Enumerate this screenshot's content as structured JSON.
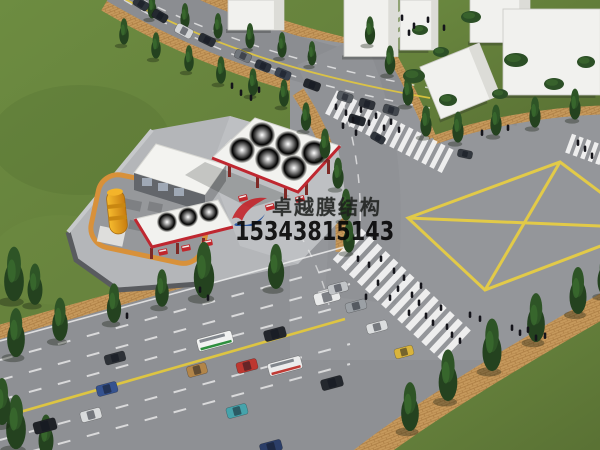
{
  "watermark": {
    "company": "卓越膜结构",
    "phone": "15343815143",
    "logo_colors": {
      "red": "#c42128",
      "blue": "#1f4e9c"
    }
  },
  "scene": {
    "description": "Aerial 3D rendering of a gas station with white tensile membrane canopies beside a multi-lane city road intersection with a yellow box-junction marking",
    "palette": {
      "grass": "#617f38",
      "road": "#909296",
      "sidewalk_brick": "#c6995c",
      "lane_yellow": "#e2c83e",
      "crosswalk_white": "#f7f7f7",
      "canopy_white": "#f2f2ef",
      "canopy_trim_red": "#bf2730",
      "tree_green": "#24421f",
      "building_white": "#f1f1ee",
      "fuel_tank_orange": "#e8a125",
      "tank_ring_orange": "#d8913a"
    },
    "buildings": [
      {
        "x": 419,
        "y": 25,
        "w": 38,
        "h": 50,
        "r": 0
      },
      {
        "x": 256,
        "y": 15,
        "w": 56,
        "h": 30,
        "r": 0
      },
      {
        "x": 371,
        "y": 28,
        "w": 54,
        "h": 57,
        "r": 0
      },
      {
        "x": 500,
        "y": 21,
        "w": 60,
        "h": 43,
        "r": 0
      },
      {
        "x": 562,
        "y": 52,
        "w": 118,
        "h": 86,
        "r": 0
      },
      {
        "x": 460,
        "y": 81,
        "w": 64,
        "h": 56,
        "r": -22
      }
    ],
    "crosswalks": [
      {
        "x": 402,
        "y": 295,
        "a": 43,
        "len": 150,
        "wid": 42,
        "step": 11,
        "sw": 6.5
      },
      {
        "x": 388,
        "y": 131,
        "a": 27,
        "len": 128,
        "wid": 26,
        "step": 9,
        "sw": 5
      },
      {
        "x": 593,
        "y": 152,
        "a": 20,
        "len": 52,
        "wid": 20,
        "step": 8,
        "sw": 4.5
      },
      {
        "x": 397,
        "y": 22,
        "a": 52,
        "len": 46,
        "wid": 18,
        "step": 8,
        "sw": 4.5
      }
    ],
    "cars": [
      {
        "x": 141,
        "y": 4,
        "a": 32,
        "c": "#2e343b",
        "l": 16,
        "w": 9
      },
      {
        "x": 160,
        "y": 16,
        "a": 30,
        "c": "#23282f",
        "l": 16,
        "w": 9
      },
      {
        "x": 184,
        "y": 31,
        "a": 28,
        "c": "#d3d5d7",
        "l": 18,
        "w": 10
      },
      {
        "x": 207,
        "y": 40,
        "a": 26,
        "c": "#282d34",
        "l": 17,
        "w": 9
      },
      {
        "x": 243,
        "y": 56,
        "a": 24,
        "c": "#70757b",
        "l": 17,
        "w": 9
      },
      {
        "x": 263,
        "y": 66,
        "a": 23,
        "c": "#2c323c",
        "l": 16,
        "w": 9
      },
      {
        "x": 283,
        "y": 74,
        "a": 22,
        "c": "#39414e",
        "l": 16,
        "w": 9
      },
      {
        "x": 312,
        "y": 85,
        "a": 20,
        "c": "#22262c",
        "l": 17,
        "w": 9
      },
      {
        "x": 345,
        "y": 97,
        "a": 18,
        "c": "#585d63",
        "l": 16,
        "w": 9
      },
      {
        "x": 367,
        "y": 104,
        "a": 17,
        "c": "#2f333a",
        "l": 16,
        "w": 9
      },
      {
        "x": 391,
        "y": 110,
        "a": 16,
        "c": "#42474e",
        "l": 16,
        "w": 9
      },
      {
        "x": 357,
        "y": 120,
        "a": 17,
        "c": "#23272d",
        "l": 17,
        "w": 9
      },
      {
        "x": 378,
        "y": 138,
        "a": 30,
        "c": "#30353c",
        "l": 15,
        "w": 8
      },
      {
        "x": 465,
        "y": 154,
        "a": 12,
        "c": "#33383f",
        "l": 15,
        "w": 8
      },
      {
        "x": 215,
        "y": 341,
        "a": -15,
        "c": "#f1f2f1",
        "l": 36,
        "w": 13,
        "s": "#2e8f3e"
      },
      {
        "x": 275,
        "y": 334,
        "a": -15,
        "c": "#23262c",
        "l": 22,
        "w": 11
      },
      {
        "x": 327,
        "y": 297,
        "a": -15,
        "c": "#e9eaea",
        "l": 26,
        "w": 12
      },
      {
        "x": 356,
        "y": 306,
        "a": -15,
        "c": "#9ba0a5",
        "l": 21,
        "w": 10
      },
      {
        "x": 377,
        "y": 327,
        "a": -15,
        "c": "#dcdedf",
        "l": 21,
        "w": 10
      },
      {
        "x": 338,
        "y": 288,
        "a": -15,
        "c": "#c2c5c8",
        "l": 20,
        "w": 10
      },
      {
        "x": 247,
        "y": 366,
        "a": -15,
        "c": "#bd3730",
        "l": 21,
        "w": 11
      },
      {
        "x": 197,
        "y": 370,
        "a": -15,
        "c": "#b28549",
        "l": 20,
        "w": 11
      },
      {
        "x": 285,
        "y": 366,
        "a": -15,
        "c": "#ebecec",
        "l": 34,
        "w": 13,
        "s": "#bf3a34"
      },
      {
        "x": 332,
        "y": 383,
        "a": -15,
        "c": "#24282e",
        "l": 22,
        "w": 11
      },
      {
        "x": 237,
        "y": 411,
        "a": -15,
        "c": "#46a3ab",
        "l": 21,
        "w": 11
      },
      {
        "x": 271,
        "y": 447,
        "a": -15,
        "c": "#2b3e68",
        "l": 22,
        "w": 11
      },
      {
        "x": 45,
        "y": 426,
        "a": -15,
        "c": "#1f2227",
        "l": 23,
        "w": 12
      },
      {
        "x": 91,
        "y": 415,
        "a": -15,
        "c": "#d9dbdc",
        "l": 21,
        "w": 11
      },
      {
        "x": 107,
        "y": 389,
        "a": -15,
        "c": "#35528f",
        "l": 21,
        "w": 11
      },
      {
        "x": 115,
        "y": 358,
        "a": -15,
        "c": "#2d3137",
        "l": 21,
        "w": 10
      },
      {
        "x": 404,
        "y": 352,
        "a": -15,
        "c": "#d9b43c",
        "l": 19,
        "w": 10
      }
    ],
    "trees": [
      [
        152,
        18,
        26
      ],
      [
        185,
        28,
        27
      ],
      [
        218,
        38,
        27
      ],
      [
        250,
        48,
        27
      ],
      [
        282,
        57,
        27
      ],
      [
        312,
        65,
        26
      ],
      [
        124,
        44,
        28
      ],
      [
        156,
        58,
        28
      ],
      [
        189,
        71,
        28
      ],
      [
        221,
        83,
        29
      ],
      [
        253,
        95,
        29
      ],
      [
        284,
        106,
        29
      ],
      [
        306,
        130,
        30
      ],
      [
        325,
        158,
        32
      ],
      [
        338,
        188,
        33
      ],
      [
        346,
        220,
        34
      ],
      [
        349,
        252,
        34
      ],
      [
        370,
        44,
        30
      ],
      [
        390,
        74,
        31
      ],
      [
        408,
        105,
        32
      ],
      [
        426,
        136,
        33
      ],
      [
        458,
        142,
        33
      ],
      [
        496,
        135,
        33
      ],
      [
        535,
        127,
        33
      ],
      [
        575,
        119,
        33
      ],
      [
        16,
        356,
        52
      ],
      [
        60,
        340,
        46
      ],
      [
        114,
        322,
        42
      ],
      [
        162,
        306,
        40
      ],
      [
        204,
        297,
        60
      ],
      [
        276,
        288,
        48
      ],
      [
        410,
        430,
        52
      ],
      [
        448,
        400,
        55
      ],
      [
        492,
        370,
        56
      ],
      [
        536,
        341,
        52
      ],
      [
        578,
        313,
        50
      ],
      [
        605,
        295,
        44
      ],
      [
        14,
        300,
        58
      ],
      [
        35,
        304,
        44
      ],
      [
        16,
        448,
        58
      ],
      [
        46,
        455,
        44
      ],
      [
        2,
        424,
        50
      ]
    ],
    "bushes": [
      [
        414,
        76,
        11,
        7
      ],
      [
        448,
        100,
        9,
        6
      ],
      [
        516,
        60,
        12,
        7
      ],
      [
        554,
        84,
        10,
        6
      ],
      [
        586,
        62,
        9,
        6
      ],
      [
        471,
        17,
        10,
        6
      ],
      [
        441,
        52,
        8,
        5
      ],
      [
        500,
        94,
        8,
        5
      ],
      [
        420,
        30,
        8,
        5
      ]
    ],
    "pedestrians": [
      [
        358,
        262
      ],
      [
        369,
        268
      ],
      [
        381,
        262
      ],
      [
        394,
        274
      ],
      [
        404,
        281
      ],
      [
        398,
        292
      ],
      [
        412,
        298
      ],
      [
        419,
        306
      ],
      [
        409,
        316
      ],
      [
        426,
        319
      ],
      [
        433,
        326
      ],
      [
        441,
        311
      ],
      [
        390,
        301
      ],
      [
        378,
        286
      ],
      [
        366,
        300
      ],
      [
        421,
        289
      ],
      [
        447,
        330
      ],
      [
        452,
        338
      ],
      [
        336,
        110
      ],
      [
        346,
        116
      ],
      [
        353,
        123
      ],
      [
        361,
        113
      ],
      [
        369,
        126
      ],
      [
        376,
        119
      ],
      [
        384,
        131
      ],
      [
        391,
        125
      ],
      [
        399,
        133
      ],
      [
        356,
        136
      ],
      [
        343,
        129
      ],
      [
        512,
        331
      ],
      [
        520,
        336
      ],
      [
        528,
        333
      ],
      [
        536,
        341
      ],
      [
        545,
        339
      ],
      [
        460,
        344
      ],
      [
        470,
        318
      ],
      [
        480,
        322
      ],
      [
        402,
        21
      ],
      [
        414,
        29
      ],
      [
        428,
        23
      ],
      [
        444,
        31
      ],
      [
        409,
        36
      ],
      [
        232,
        89
      ],
      [
        241,
        96
      ],
      [
        251,
        101
      ],
      [
        259,
        93
      ],
      [
        200,
        293
      ],
      [
        208,
        301
      ],
      [
        127,
        319
      ],
      [
        585,
        152
      ],
      [
        592,
        159
      ],
      [
        578,
        146
      ],
      [
        482,
        136
      ],
      [
        508,
        131
      ]
    ]
  }
}
